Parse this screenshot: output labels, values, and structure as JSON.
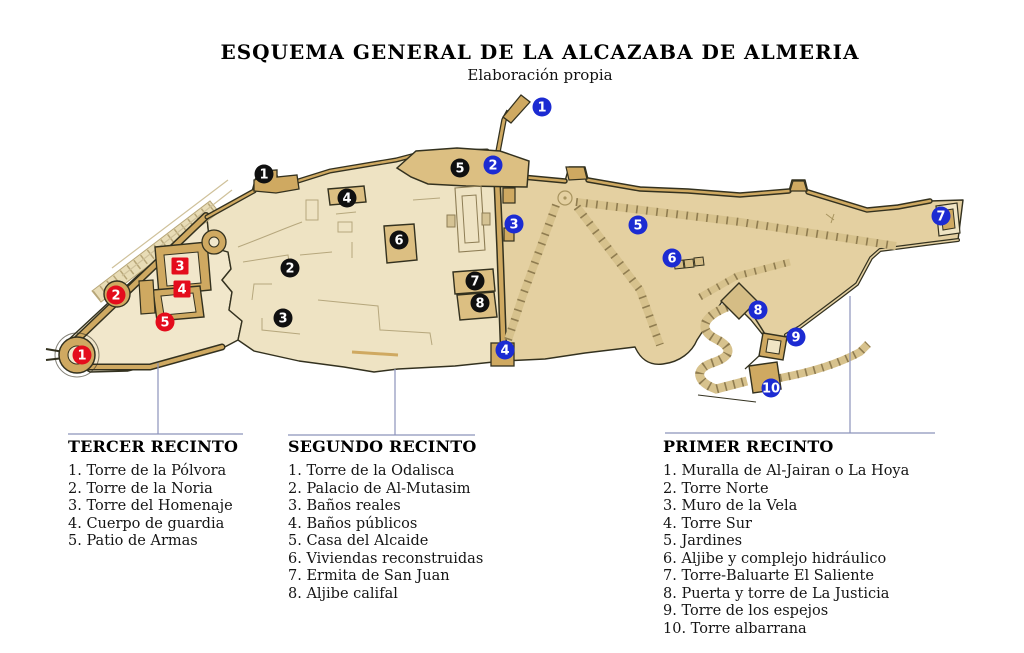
{
  "title": "ESQUEMA GENERAL DE LA ALCAZABA DE ALMERIA",
  "subtitle": "Elaboración propia",
  "palette": {
    "interior_light": "#f1e7cb",
    "interior_mid": "#eee3c3",
    "interior_dark": "#e4d0a1",
    "wall_tan": "#cfa961",
    "building_tan": "#dcbf82",
    "outline": "#33311f",
    "leader_line": "#8c93bb",
    "marker_red": "#e40c1c",
    "marker_black": "#101010",
    "marker_blue": "#1c2bd2"
  },
  "map": {
    "marker_groups": [
      {
        "name": "tercer-recinto-markers",
        "color": "#e40c1c",
        "markers": [
          {
            "n": "1",
            "x": 82,
            "y": 355
          },
          {
            "n": "2",
            "x": 116,
            "y": 295
          },
          {
            "n": "3",
            "x": 180,
            "y": 266,
            "shape": "square"
          },
          {
            "n": "4",
            "x": 182,
            "y": 289,
            "shape": "square"
          },
          {
            "n": "5",
            "x": 165,
            "y": 322
          }
        ]
      },
      {
        "name": "segundo-recinto-markers",
        "color": "#101010",
        "markers": [
          {
            "n": "1",
            "x": 264,
            "y": 174
          },
          {
            "n": "2",
            "x": 290,
            "y": 268
          },
          {
            "n": "3",
            "x": 283,
            "y": 318
          },
          {
            "n": "4",
            "x": 347,
            "y": 198
          },
          {
            "n": "5",
            "x": 460,
            "y": 168
          },
          {
            "n": "6",
            "x": 399,
            "y": 240
          },
          {
            "n": "7",
            "x": 475,
            "y": 281
          },
          {
            "n": "8",
            "x": 480,
            "y": 303
          }
        ]
      },
      {
        "name": "primer-recinto-markers",
        "color": "#1c2bd2",
        "markers": [
          {
            "n": "1",
            "x": 542,
            "y": 107
          },
          {
            "n": "2",
            "x": 493,
            "y": 165
          },
          {
            "n": "3",
            "x": 514,
            "y": 224
          },
          {
            "n": "4",
            "x": 505,
            "y": 350
          },
          {
            "n": "5",
            "x": 638,
            "y": 225
          },
          {
            "n": "6",
            "x": 672,
            "y": 258
          },
          {
            "n": "7",
            "x": 941,
            "y": 216
          },
          {
            "n": "8",
            "x": 758,
            "y": 310
          },
          {
            "n": "9",
            "x": 796,
            "y": 337
          },
          {
            "n": "10",
            "x": 771,
            "y": 388
          }
        ]
      }
    ]
  },
  "legends": [
    {
      "title": "TERCER RECINTO",
      "items": [
        "1. Torre de la Pólvora",
        "2. Torre de la Noria",
        "3. Torre del Homenaje",
        "4. Cuerpo de guardia",
        "5. Patio de Armas"
      ]
    },
    {
      "title": "SEGUNDO RECINTO",
      "items": [
        "1. Torre de la Odalisca",
        "2. Palacio de Al-Mutasim",
        "3. Baños reales",
        "4. Baños públicos",
        "5. Casa del Alcaide",
        "6. Viviendas reconstruidas",
        "7. Ermita de San Juan",
        "8. Aljibe califal"
      ]
    },
    {
      "title": "PRIMER RECINTO",
      "items": [
        "1. Muralla de Al-Jairan o La Hoya",
        "2. Torre Norte",
        "3. Muro de la Vela",
        "4. Torre Sur",
        "5. Jardines",
        "6. Aljibe y complejo hidráulico",
        "7. Torre-Baluarte El Saliente",
        "8. Puerta y torre de La Justicia",
        "9. Torre de los espejos",
        "10. Torre albarrana"
      ]
    }
  ]
}
